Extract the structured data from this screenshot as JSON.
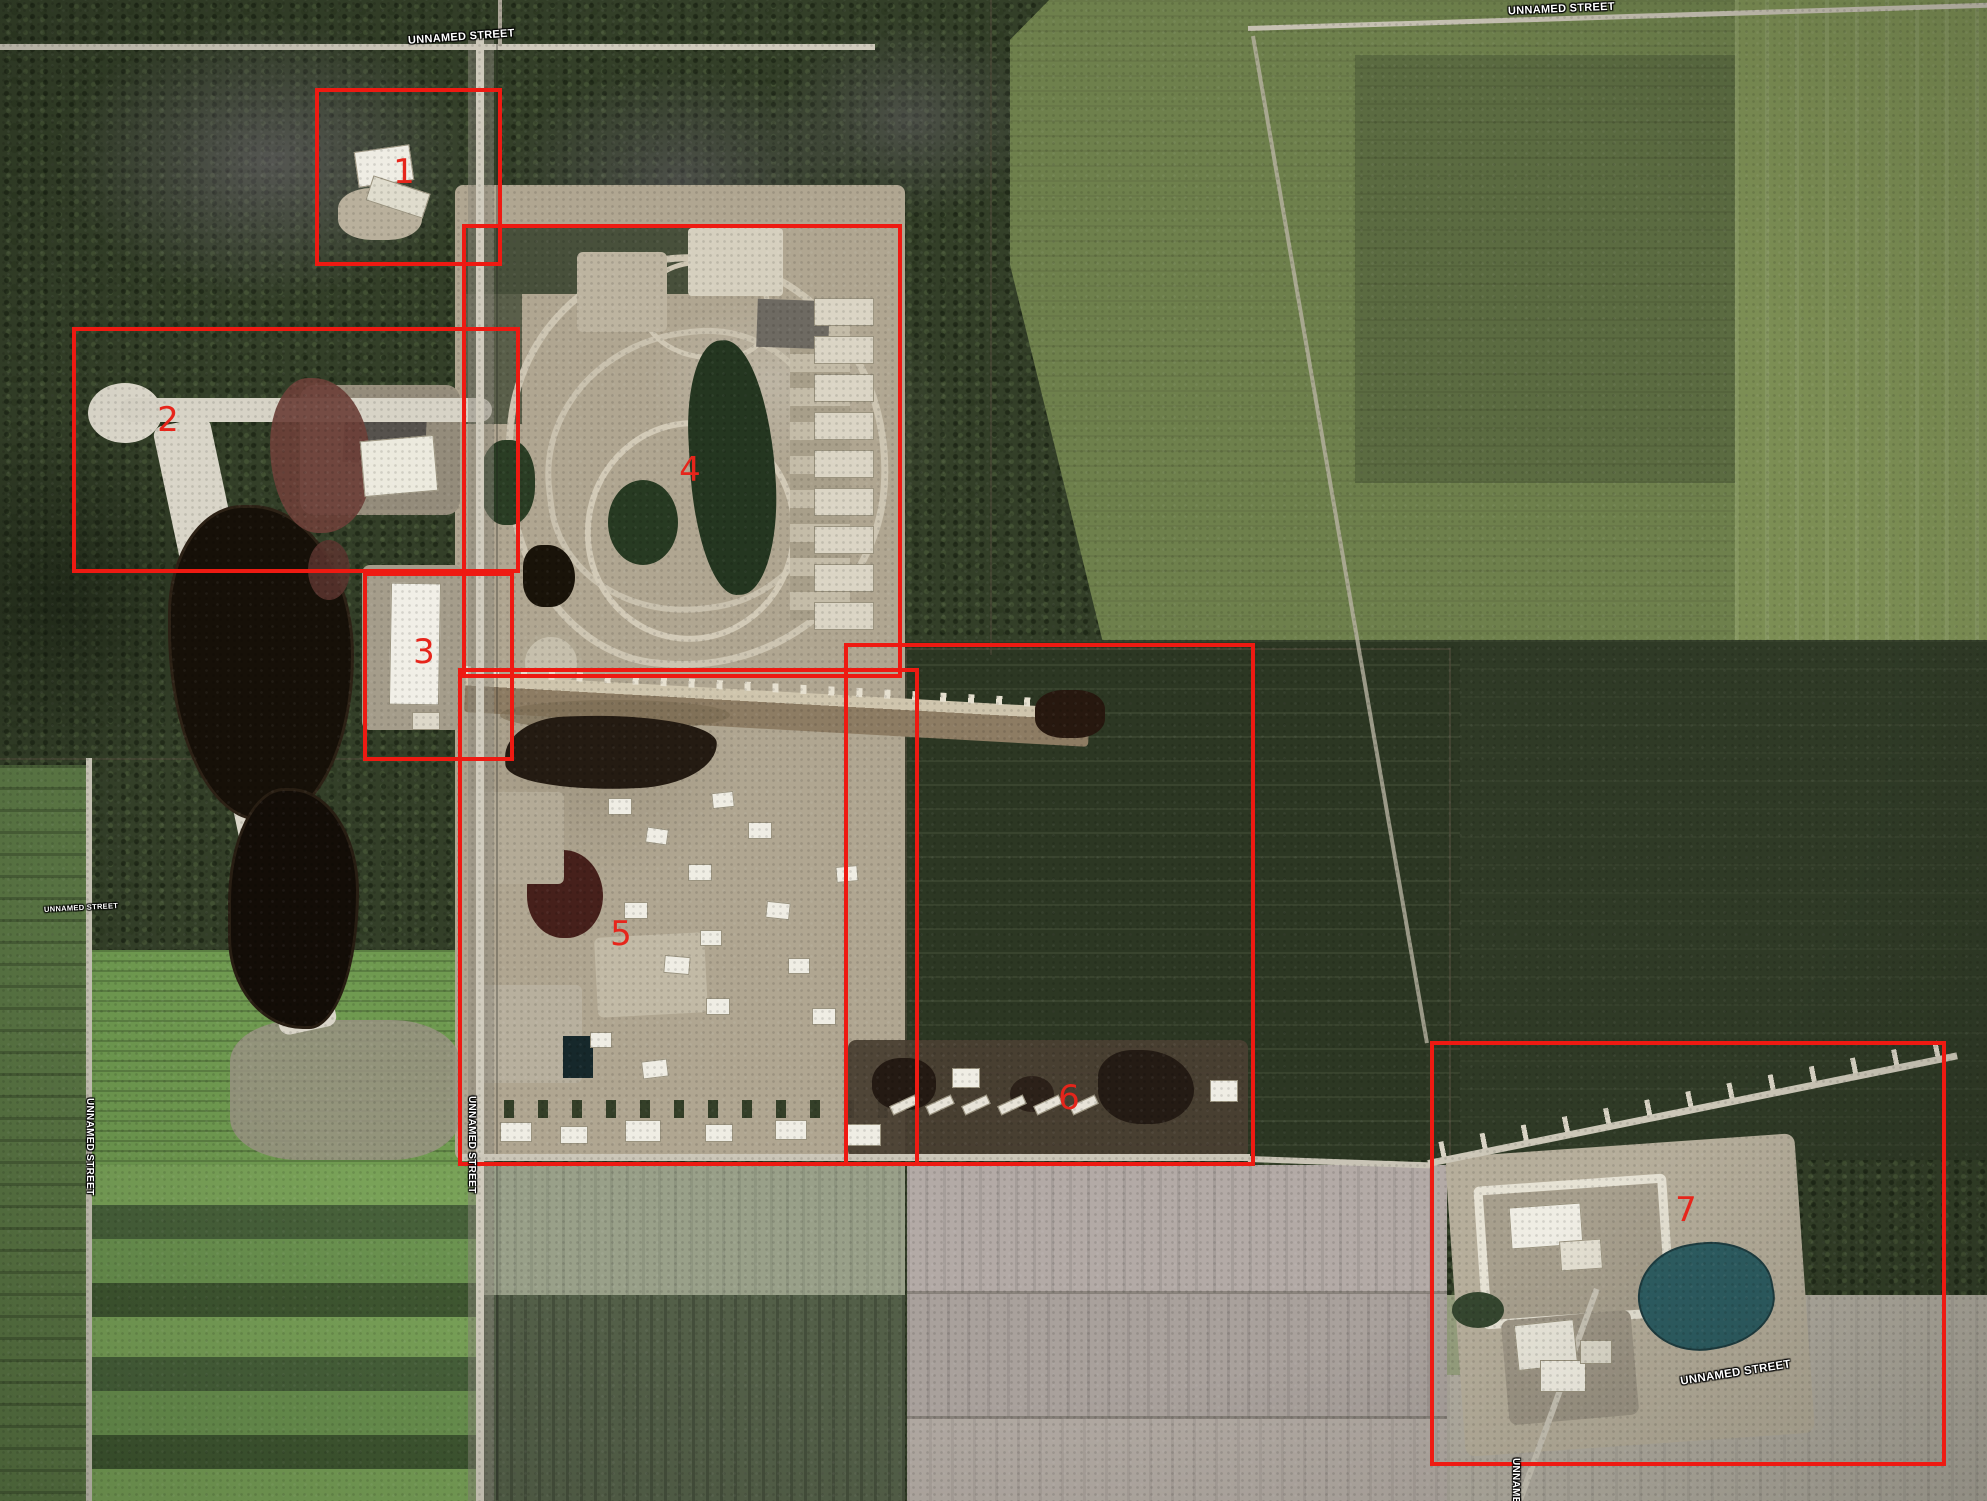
{
  "map": {
    "type": "satellite-aerial-annotated",
    "street_label_color": "#ffffff"
  },
  "annotations": {
    "box_color": "#ee1a12",
    "number_color": "#e6251b",
    "boxes": [
      {
        "number": "1",
        "x": 315,
        "y": 88,
        "w": 179,
        "h": 170,
        "nx": 404,
        "ny": 172
      },
      {
        "number": "2",
        "x": 72,
        "y": 327,
        "w": 440,
        "h": 238,
        "nx": 168,
        "ny": 420
      },
      {
        "number": "3",
        "x": 363,
        "y": 572,
        "w": 143,
        "h": 181,
        "nx": 424,
        "ny": 652
      },
      {
        "number": "4",
        "x": 462,
        "y": 224,
        "w": 432,
        "h": 446,
        "nx": 690,
        "ny": 470
      },
      {
        "number": "5",
        "x": 458,
        "y": 668,
        "w": 453,
        "h": 490,
        "nx": 621,
        "ny": 934
      },
      {
        "number": "6",
        "x": 844,
        "y": 643,
        "w": 403,
        "h": 515,
        "nx": 1069,
        "ny": 1098
      },
      {
        "number": "7",
        "x": 1430,
        "y": 1041,
        "w": 508,
        "h": 417,
        "nx": 1686,
        "ny": 1210
      }
    ]
  },
  "street_labels": [
    {
      "text": "UNNAMED STREET",
      "x": 408,
      "y": 32,
      "rotate": -4,
      "vertical": false,
      "size": 11
    },
    {
      "text": "UNNAMED STREET",
      "x": 1508,
      "y": 4,
      "rotate": -2.5,
      "vertical": false,
      "size": 11
    },
    {
      "text": "UNNAMED STREET",
      "x": 44,
      "y": 904,
      "rotate": -3,
      "vertical": false,
      "size": 7.5
    },
    {
      "text": "UNNAMED STREET",
      "x": 84,
      "y": 1098,
      "rotate": 0,
      "vertical": true,
      "size": 10
    },
    {
      "text": "UNNAMED STREET",
      "x": 466,
      "y": 1096,
      "rotate": 0,
      "vertical": true,
      "size": 10
    },
    {
      "text": "UNNAMED STREET",
      "x": 1680,
      "y": 1368,
      "rotate": -9,
      "vertical": false,
      "size": 11.5
    },
    {
      "text": "UNNAMED STREET",
      "x": 1510,
      "y": 1458,
      "rotate": 0,
      "vertical": true,
      "size": 10
    }
  ]
}
